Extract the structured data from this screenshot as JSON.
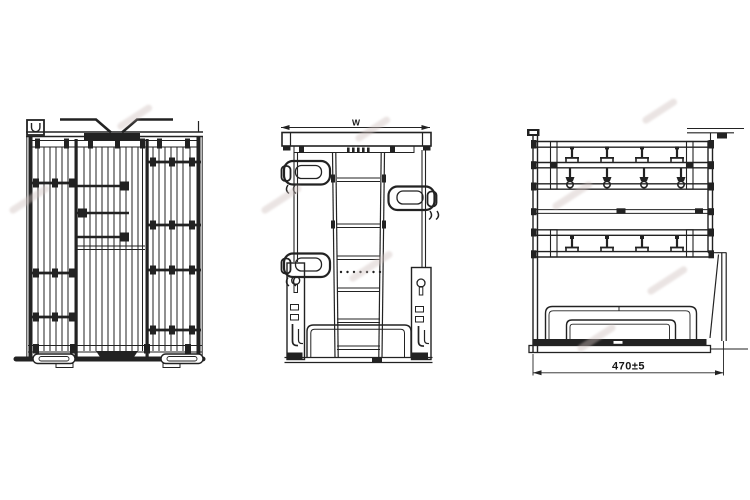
{
  "drawing": {
    "background_color": "#ffffff",
    "line_color": "#222222",
    "watermark_color": "#cfc0bd",
    "views": {
      "side": {
        "top_width_dimension_label": "W"
      },
      "rear": {
        "bottom_width_dimension_label": "470±5"
      }
    }
  }
}
